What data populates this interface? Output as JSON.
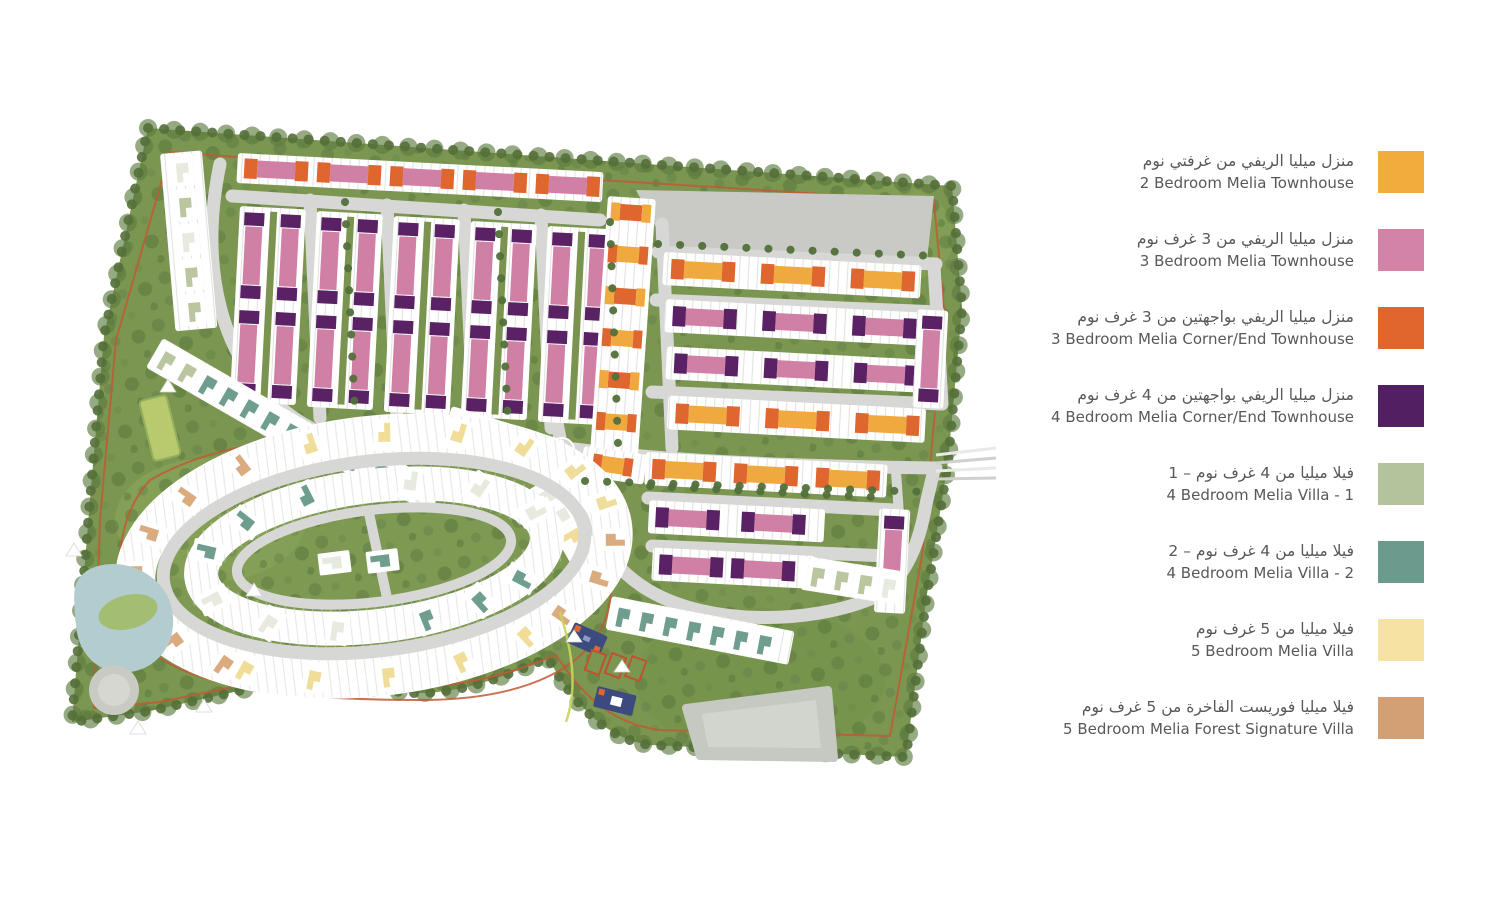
{
  "legend": {
    "items": [
      {
        "ar": "منزل ميليا الريفي من غرفتي نوم",
        "en": "2 Bedroom Melia Townhouse",
        "color": "#F2AC3E"
      },
      {
        "ar": "منزل ميليا الريفي من 3 غرف نوم",
        "en": "3 Bedroom Melia Townhouse",
        "color": "#D383A6"
      },
      {
        "ar": "منزل ميليا الريفي بواجهتين من 3 غرف نوم",
        "en": "3 Bedroom Melia Corner/End Townhouse",
        "color": "#E0662E"
      },
      {
        "ar": "منزل ميليا الريفي بواجهتين من 4 غرف نوم",
        "en": "4 Bedroom Melia Corner/End Townhouse",
        "color": "#521F62"
      },
      {
        "ar": "فيلا ميليا من 4 غرف نوم – 1",
        "en": "4 Bedroom Melia Villa - 1",
        "color": "#B5C39C"
      },
      {
        "ar": "فيلا ميليا من 4 غرف نوم – 2",
        "en": "4 Bedroom Melia Villa - 2",
        "color": "#6B9B8C"
      },
      {
        "ar": "فيلا ميليا من 5 غرف نوم",
        "en": "5 Bedroom Melia Villa",
        "color": "#F6E3A3"
      },
      {
        "ar": "فيلا ميليا فوريست الفاخرة من 5 غرف نوم",
        "en": "5 Bedroom Melia Forest Signature Villa",
        "color": "#D2A074"
      }
    ]
  },
  "map": {
    "colors": {
      "site_green": "#7B9650",
      "tree_green": "#55713A",
      "road_gray": "#D7D7D5",
      "reserved_parcel_gray": "#C9CAC6",
      "lake_blue": "#B2CCD0",
      "trail_red": "#C05A35",
      "amenity_navy": "#3C4A80"
    }
  }
}
